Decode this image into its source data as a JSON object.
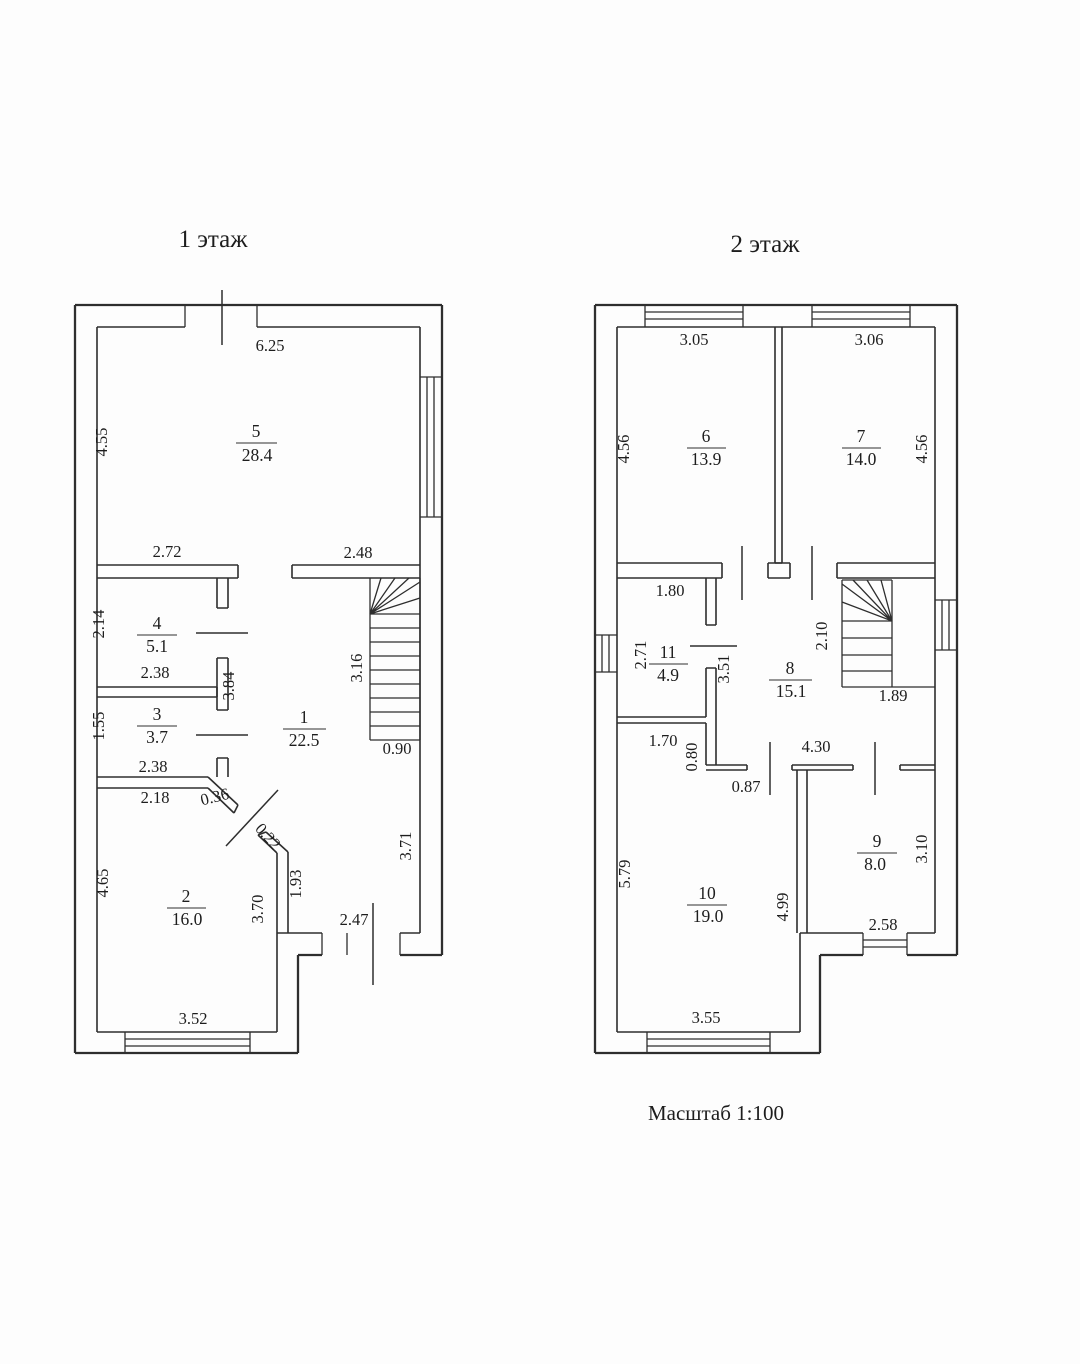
{
  "floor1": {
    "title": "1 этаж",
    "rooms": {
      "r1": {
        "number": "1",
        "area": "22.5"
      },
      "r2": {
        "number": "2",
        "area": "16.0"
      },
      "r3": {
        "number": "3",
        "area": "3.7"
      },
      "r4": {
        "number": "4",
        "area": "5.1"
      },
      "r5": {
        "number": "5",
        "area": "28.4"
      }
    },
    "dims": {
      "top_width": "6.25",
      "r5_height": "4.55",
      "wall_272": "2.72",
      "wall_248": "2.48",
      "r4_height": "2.14",
      "r4_width": "2.38",
      "wall_384": "3.84",
      "r3_height": "1.55",
      "r3_width": "2.38",
      "stairs_height": "3.16",
      "stairs_width": "0.90",
      "seg_218": "2.18",
      "seg_036": "0.36",
      "seg_022": "0.22",
      "r2_height": "4.65",
      "r2_width": "3.52",
      "wall_370": "3.70",
      "wall_193": "1.93",
      "wall_371": "3.71",
      "entry_width": "2.47"
    }
  },
  "floor2": {
    "title": "2 этаж",
    "rooms": {
      "r6": {
        "number": "6",
        "area": "13.9"
      },
      "r7": {
        "number": "7",
        "area": "14.0"
      },
      "r8": {
        "number": "8",
        "area": "15.1"
      },
      "r9": {
        "number": "9",
        "area": "8.0"
      },
      "r10": {
        "number": "10",
        "area": "19.0"
      },
      "r11": {
        "number": "11",
        "area": "4.9"
      }
    },
    "dims": {
      "r6_width": "3.05",
      "r7_width": "3.06",
      "r6_height": "4.56",
      "r7_height": "4.56",
      "r11_width": "1.80",
      "r11_height": "2.71",
      "wall_351": "3.51",
      "stairs_height": "2.10",
      "stairs_width": "1.89",
      "seg_170": "1.70",
      "seg_080": "0.80",
      "door_087": "0.87",
      "hall_width": "4.30",
      "r10_height": "5.79",
      "r10_width": "3.55",
      "wall_499": "4.99",
      "r9_height": "3.10",
      "r9_width": "2.58"
    }
  },
  "scale_note": "Масштаб 1:100"
}
